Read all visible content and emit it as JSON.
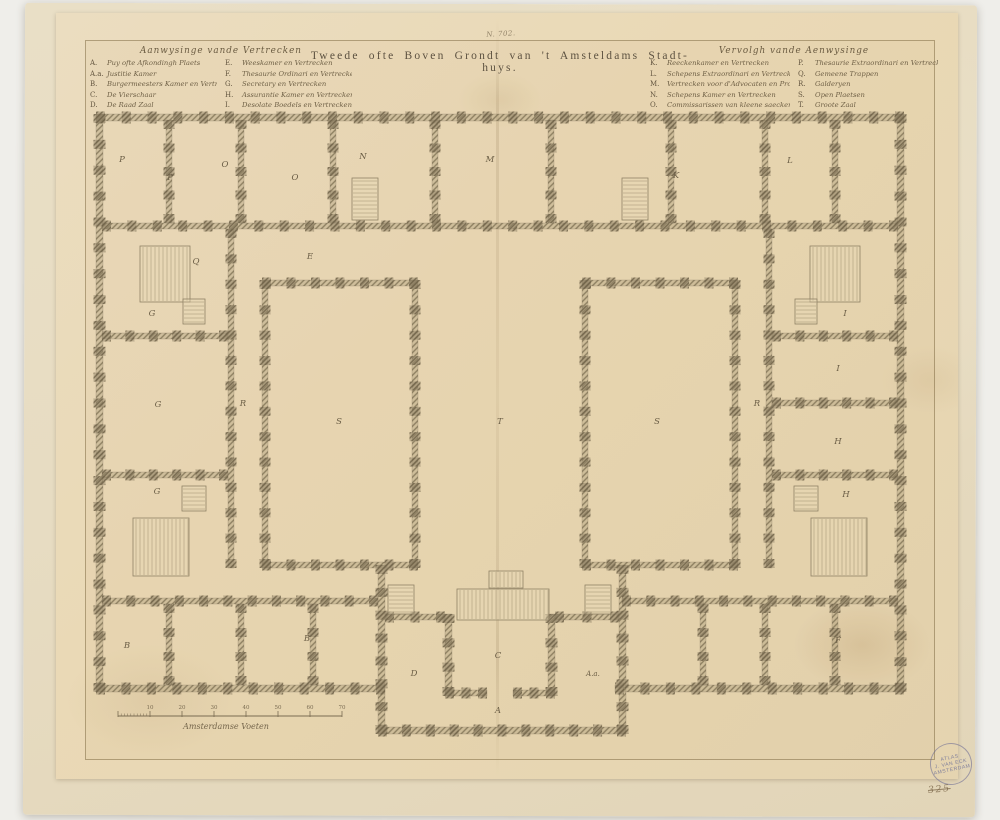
{
  "note_top": "N. 702.",
  "title": "Tweede ofte Boven Grondt van 't Amsteldams Stadt-huys.",
  "legend_left": {
    "header": "Aanwysinge vande Vertrecken",
    "col1": [
      [
        "A.",
        "Puy ofte Afkondingh Plaets"
      ],
      [
        "A.a.",
        "Justitie Kamer"
      ],
      [
        "B.",
        "Burgermeesters Kamer en Vertrecken"
      ],
      [
        "C.",
        "De Vierschaar"
      ],
      [
        "D.",
        "De Raad Zaal"
      ]
    ],
    "col2": [
      [
        "E.",
        "Weeskamer en Vertrecken"
      ],
      [
        "F.",
        "Thesaurie Ordinari en Vertrecken"
      ],
      [
        "G.",
        "Secretary en Vertrecken"
      ],
      [
        "H.",
        "Assurantie Kamer en Vertrecken"
      ],
      [
        "I.",
        "Desolate Boedels en Vertrecken"
      ]
    ]
  },
  "legend_right": {
    "header": "Vervolgh vande Aenwysinge",
    "col1": [
      [
        "K.",
        "Reeckenkamer en Vertrecken"
      ],
      [
        "L.",
        "Schepens Extraordinari en Vertreck"
      ],
      [
        "M.",
        "Vertrecken voor d'Advocaten en Procureurs"
      ],
      [
        "N.",
        "Schepens Kamer en Vertrecken"
      ],
      [
        "O.",
        "Commissarissen van kleene saecken en Vertr."
      ]
    ],
    "col2": [
      [
        "P.",
        "Thesaurie Extraordinari en Vertrecken"
      ],
      [
        "Q.",
        "Gemeene Trappen"
      ],
      [
        "R.",
        "Galderyen"
      ],
      [
        "S.",
        "Open Plaetsen"
      ],
      [
        "T.",
        "Groote Zaal"
      ]
    ]
  },
  "stamp": {
    "line1": "ATLAS",
    "line2": "J. VAN ECK",
    "line3": "AMSTERDAM",
    "number": "325"
  },
  "colors": {
    "mount_paper": "#e7dcc2",
    "print_paper": "#ead9b6",
    "ink": "#6e5f45",
    "wall_hatch": "#8f8263",
    "stamp_ink": "#7e7e9b"
  },
  "plan": {
    "walls": [
      [
        96,
        114,
        808,
        7
      ],
      [
        96,
        114,
        7,
        578
      ],
      [
        897,
        114,
        7,
        578
      ],
      [
        96,
        685,
        289,
        7
      ],
      [
        615,
        685,
        289,
        7
      ],
      [
        378,
        565,
        7,
        169
      ],
      [
        619,
        565,
        7,
        169
      ],
      [
        378,
        727,
        248,
        7
      ],
      [
        102,
        223,
        796,
        6
      ],
      [
        228,
        229,
        6,
        339
      ],
      [
        766,
        229,
        6,
        339
      ],
      [
        102,
        598,
        276,
        6
      ],
      [
        622,
        598,
        276,
        6
      ],
      [
        262,
        280,
        6,
        288
      ],
      [
        262,
        280,
        156,
        6
      ],
      [
        262,
        562,
        156,
        6
      ],
      [
        412,
        280,
        6,
        288
      ],
      [
        582,
        280,
        6,
        288
      ],
      [
        582,
        280,
        156,
        6
      ],
      [
        582,
        562,
        156,
        6
      ],
      [
        732,
        280,
        6,
        288
      ],
      [
        166,
        120,
        6,
        103
      ],
      [
        238,
        120,
        6,
        103
      ],
      [
        330,
        120,
        6,
        103
      ],
      [
        432,
        120,
        6,
        103
      ],
      [
        548,
        120,
        6,
        103
      ],
      [
        668,
        120,
        6,
        103
      ],
      [
        762,
        120,
        6,
        103
      ],
      [
        832,
        120,
        6,
        103
      ],
      [
        166,
        604,
        6,
        81
      ],
      [
        238,
        604,
        6,
        81
      ],
      [
        310,
        604,
        6,
        81
      ],
      [
        700,
        604,
        6,
        81
      ],
      [
        762,
        604,
        6,
        81
      ],
      [
        832,
        604,
        6,
        81
      ],
      [
        102,
        333,
        126,
        6
      ],
      [
        102,
        472,
        126,
        6
      ],
      [
        772,
        333,
        126,
        6
      ],
      [
        772,
        400,
        126,
        6
      ],
      [
        772,
        472,
        126,
        6
      ],
      [
        445,
        614,
        7,
        82
      ],
      [
        548,
        614,
        7,
        82
      ],
      [
        445,
        690,
        42,
        6
      ],
      [
        513,
        690,
        42,
        6
      ],
      [
        385,
        614,
        60,
        6
      ],
      [
        555,
        614,
        64,
        6
      ]
    ],
    "stairs": [
      [
        140,
        246,
        50,
        56,
        "h"
      ],
      [
        810,
        246,
        50,
        56,
        "h"
      ],
      [
        133,
        518,
        56,
        58,
        "h"
      ],
      [
        811,
        518,
        56,
        58,
        "h"
      ],
      [
        352,
        178,
        26,
        42,
        "v"
      ],
      [
        622,
        178,
        26,
        42,
        "v"
      ],
      [
        183,
        299,
        22,
        25,
        "v"
      ],
      [
        182,
        486,
        24,
        25,
        "v"
      ],
      [
        795,
        299,
        22,
        25,
        "v"
      ],
      [
        794,
        486,
        24,
        25,
        "v"
      ],
      [
        457,
        589,
        92,
        31,
        "h"
      ],
      [
        489,
        571,
        34,
        17,
        "h"
      ],
      [
        388,
        585,
        26,
        29,
        "v"
      ],
      [
        585,
        585,
        26,
        29,
        "v"
      ]
    ],
    "room_labels": [
      [
        "P",
        122,
        162
      ],
      [
        "P",
        170,
        180
      ],
      [
        "O",
        225,
        167
      ],
      [
        "O",
        295,
        180
      ],
      [
        "N",
        363,
        159
      ],
      [
        "M",
        490,
        162
      ],
      [
        "K",
        676,
        178
      ],
      [
        "L",
        790,
        163
      ],
      [
        "Q",
        196,
        264
      ],
      [
        "E",
        310,
        259
      ],
      [
        "G",
        152,
        316
      ],
      [
        "G",
        158,
        407
      ],
      [
        "G",
        157,
        494
      ],
      [
        "R",
        243,
        406
      ],
      [
        "R",
        757,
        406
      ],
      [
        "S",
        339,
        424
      ],
      [
        "T",
        500,
        424
      ],
      [
        "S",
        657,
        424
      ],
      [
        "I",
        845,
        316
      ],
      [
        "I",
        838,
        371
      ],
      [
        "H",
        838,
        444
      ],
      [
        "H",
        846,
        497
      ],
      [
        "B",
        127,
        648
      ],
      [
        "B",
        307,
        641
      ],
      [
        "F",
        838,
        643
      ],
      [
        "D",
        414,
        676
      ],
      [
        "C",
        498,
        658
      ],
      [
        "A",
        498,
        713
      ],
      [
        "A.a.",
        593,
        676
      ]
    ],
    "scale_bar": {
      "x": 118,
      "y": 716,
      "length": 224,
      "segments": 7,
      "tick_labels": [
        "10",
        "20",
        "30",
        "40",
        "50",
        "60",
        "70"
      ],
      "label": "Amsterdamse Voeten"
    }
  }
}
